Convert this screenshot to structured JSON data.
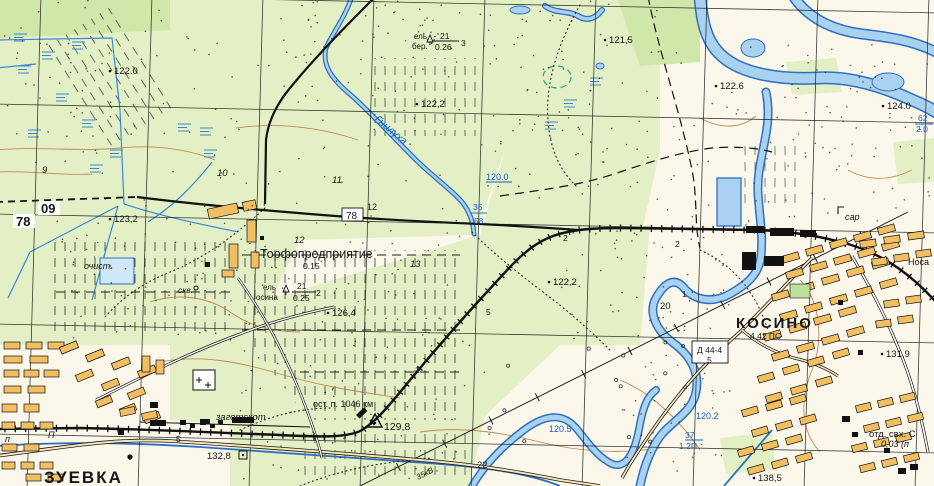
{
  "map": {
    "type": "soviet-topographic-map",
    "place_names": [
      "ЗУЕВКА",
      "КОСИНО",
      "Торфопредприятие"
    ],
    "river_name": "Гнилуха",
    "railway_stop": "ост. п. 1046 км",
    "grid_corner_labels": [
      "78",
      "09"
    ],
    "palette": {
      "paper": "#FBF7EB",
      "field_green": "#E3F0C6",
      "forest_green": "#CFE7A8",
      "dark_green": "#BFE09A",
      "water_fill": "#A9D2F0",
      "water_line": "#2F6FBF",
      "blue_text": "#1A5FC0",
      "building_orange": "#F2BE62",
      "road_fill": "#F7E3B5",
      "contour_brown": "#C08A50",
      "ink": "#161616"
    },
    "spot_elevations": [
      "122.0",
      "121,5",
      "122,2",
      "122.6",
      "124.0",
      "123,2",
      "126,4",
      "122,2",
      "129,8",
      "132,8",
      "131,9",
      "138,5"
    ],
    "water_elevations": [
      "120.0",
      "120.5",
      "120.2"
    ],
    "labels": [
      {
        "t": "122.0",
        "x": 114,
        "y": 74,
        "c": "k",
        "fs": 9.5,
        "dot": [
          110,
          71
        ]
      },
      {
        "t": "121,5",
        "x": 609,
        "y": 43,
        "c": "k",
        "fs": 9.5,
        "dot": [
          605,
          40
        ]
      },
      {
        "t": "122,2",
        "x": 421,
        "y": 107,
        "c": "k",
        "fs": 9.5,
        "dot": [
          417,
          104
        ]
      },
      {
        "t": "122.6",
        "x": 720,
        "y": 89,
        "c": "k",
        "fs": 9.5,
        "dot": [
          716,
          86
        ]
      },
      {
        "t": "124.0",
        "x": 887,
        "y": 109,
        "c": "k",
        "fs": 9.5,
        "dot": [
          883,
          106
        ]
      },
      {
        "t": "123,2",
        "x": 114,
        "y": 222,
        "c": "k",
        "fs": 9.5,
        "dot": [
          110,
          219
        ]
      },
      {
        "t": "126,4",
        "x": 332,
        "y": 316,
        "c": "k",
        "fs": 9.5,
        "dot": [
          328,
          313
        ]
      },
      {
        "t": "122,2",
        "x": 553,
        "y": 285,
        "c": "k",
        "fs": 9.5,
        "dot": [
          549,
          282
        ]
      },
      {
        "t": "129,8",
        "x": 384,
        "y": 430,
        "c": "k",
        "fs": 10.5
      },
      {
        "t": "132,8",
        "x": 207,
        "y": 459,
        "c": "k",
        "fs": 9.5
      },
      {
        "t": "131,9",
        "x": 886,
        "y": 357,
        "c": "k",
        "fs": 9.5,
        "dot": [
          882,
          354
        ]
      },
      {
        "t": "138,5",
        "x": 758,
        "y": 481,
        "c": "k",
        "fs": 9.5,
        "dot": [
          754,
          478
        ]
      },
      {
        "t": "78",
        "x": 16,
        "y": 226,
        "c": "k",
        "fs": 13,
        "w": "bold",
        "bg": [
          13,
          214,
          22,
          14
        ]
      },
      {
        "t": "09",
        "x": 41,
        "y": 213,
        "c": "k",
        "fs": 13,
        "w": "bold",
        "bg": [
          38,
          201,
          22,
          14
        ]
      },
      {
        "t": "78",
        "x": 346,
        "y": 219,
        "c": "k",
        "fs": 10,
        "bg": [
          342,
          208,
          21,
          13
        ],
        "box": 1
      },
      {
        "t": "12",
        "x": 367,
        "y": 210,
        "c": "k",
        "fs": 9
      },
      {
        "t": "Торфопредприятие",
        "x": 260,
        "y": 258,
        "c": "k",
        "fs": 12.5
      },
      {
        "t": "0.15",
        "x": 303,
        "y": 269,
        "c": "k",
        "fs": 8.5
      },
      {
        "t": "ель",
        "x": 414,
        "y": 39,
        "c": "k",
        "fs": 8
      },
      {
        "t": "бер.",
        "x": 412,
        "y": 49,
        "c": "k",
        "fs": 8
      },
      {
        "t": "21",
        "x": 440,
        "y": 39,
        "c": "k",
        "fs": 8.5
      },
      {
        "t": "0.26",
        "x": 435,
        "y": 50,
        "c": "k",
        "fs": 8.5
      },
      {
        "t": "3",
        "x": 461,
        "y": 46,
        "c": "k",
        "fs": 8.5
      },
      {
        "t": "ель",
        "x": 263,
        "y": 290,
        "c": "k",
        "fs": 8
      },
      {
        "t": "осина",
        "x": 256,
        "y": 300,
        "c": "k",
        "fs": 8
      },
      {
        "t": "21",
        "x": 297,
        "y": 289,
        "c": "k",
        "fs": 8.5
      },
      {
        "t": "0.25",
        "x": 293,
        "y": 301,
        "c": "k",
        "fs": 8.5
      },
      {
        "t": "2",
        "x": 316,
        "y": 296,
        "c": "k",
        "fs": 8.5
      },
      {
        "t": "очист.",
        "x": 84,
        "y": 269,
        "c": "k",
        "fs": 9,
        "s": "i"
      },
      {
        "t": "скв.",
        "x": 178,
        "y": 293,
        "c": "k",
        "fs": 8.5,
        "s": "i"
      },
      {
        "t": "9",
        "x": 42,
        "y": 173,
        "c": "k",
        "fs": 9.5,
        "s": "i"
      },
      {
        "t": "10",
        "x": 217,
        "y": 176,
        "c": "k",
        "fs": 9.5,
        "s": "i"
      },
      {
        "t": "11",
        "x": 332,
        "y": 183,
        "c": "k",
        "fs": 9.5,
        "s": "i"
      },
      {
        "t": "12",
        "x": 294,
        "y": 243,
        "c": "k",
        "fs": 9.5,
        "s": "i"
      },
      {
        "t": "13",
        "x": 410,
        "y": 267,
        "c": "k",
        "fs": 9.5,
        "s": "i"
      },
      {
        "t": "20",
        "x": 660,
        "y": 309,
        "c": "k",
        "fs": 9.5
      },
      {
        "t": "22",
        "x": 477,
        "y": 468,
        "c": "k",
        "fs": 9.5
      },
      {
        "t": "5",
        "x": 486,
        "y": 315,
        "c": "k",
        "fs": 8.5
      },
      {
        "t": "5",
        "x": 176,
        "y": 442,
        "c": "k",
        "fs": 8.5
      },
      {
        "t": "2",
        "x": 563,
        "y": 241,
        "c": "k",
        "fs": 8.5
      },
      {
        "t": "2",
        "x": 675,
        "y": 247,
        "c": "k",
        "fs": 8.5
      },
      {
        "t": "1",
        "x": 682,
        "y": 297,
        "c": "k",
        "fs": 8.5
      },
      {
        "t": "1",
        "x": 415,
        "y": 373,
        "c": "k",
        "fs": 8.5
      },
      {
        "t": "КОСИНО",
        "x": 736,
        "y": 328,
        "c": "k",
        "fs": 15,
        "w": "bold",
        "ls": 2
      },
      {
        "t": "4.42 ПС",
        "x": 750,
        "y": 339,
        "c": "k",
        "fs": 8.5
      },
      {
        "t": "сар",
        "x": 845,
        "y": 220,
        "c": "k",
        "fs": 9,
        "s": "i"
      },
      {
        "t": "Носа",
        "x": 908,
        "y": 265,
        "c": "k",
        "fs": 9
      },
      {
        "t": "отд. свх. С",
        "x": 869,
        "y": 437,
        "c": "k",
        "fs": 9.5
      },
      {
        "t": "0,03 (п",
        "x": 881,
        "y": 447,
        "c": "k",
        "fs": 9,
        "s": "i"
      },
      {
        "t": "заготскот",
        "x": 216,
        "y": 420,
        "c": "k",
        "fs": 9.5,
        "s": "i"
      },
      {
        "t": "ост. п. 1046 км",
        "x": 313,
        "y": 407,
        "c": "k",
        "fs": 9
      },
      {
        "t": "ЗУЕВКА",
        "x": 44,
        "y": 483,
        "c": "k",
        "fs": 17,
        "w": "bold",
        "ls": 2
      },
      {
        "t": "П",
        "x": 48,
        "y": 438,
        "c": "k",
        "fs": 9,
        "s": "i"
      },
      {
        "t": "п",
        "x": 5,
        "y": 442,
        "c": "k",
        "fs": 9,
        "s": "i"
      },
      {
        "t": "Д 44-4",
        "x": 697,
        "y": 353,
        "c": "k",
        "fs": 8.5,
        "bg": [
          692,
          341,
          36,
          22
        ],
        "box": 1
      },
      {
        "t": "5",
        "x": 707,
        "y": 363,
        "c": "k",
        "fs": 8.5
      },
      {
        "t": "Гнилуха",
        "x": 374,
        "y": 120,
        "c": "b",
        "fs": 10.5,
        "s": "i",
        "rot": 40
      },
      {
        "t": "120.0",
        "x": 486,
        "y": 180,
        "c": "b",
        "fs": 9
      },
      {
        "t": "120.5",
        "x": 549,
        "y": 432,
        "c": "b",
        "fs": 9
      },
      {
        "t": "120.2",
        "x": 696,
        "y": 419,
        "c": "b",
        "fs": 9
      },
      {
        "t": "37",
        "x": 685,
        "y": 438,
        "c": "b",
        "fs": 8.5
      },
      {
        "t": "1.2П",
        "x": 679,
        "y": 449,
        "c": "b",
        "fs": 8.5
      },
      {
        "t": "35",
        "x": 473,
        "y": 210,
        "c": "b",
        "fs": 8.5
      },
      {
        "t": "58",
        "x": 474,
        "y": 224,
        "c": "b",
        "fs": 8.5
      },
      {
        "t": "62",
        "x": 918,
        "y": 121,
        "c": "b",
        "fs": 8.5
      },
      {
        "t": "2.0",
        "x": 916,
        "y": 132,
        "c": "b",
        "fs": 8.5
      },
      {
        "t": "35кВ",
        "x": 418,
        "y": 480,
        "c": "k",
        "fs": 8,
        "s": "i",
        "rot": -27
      }
    ]
  }
}
